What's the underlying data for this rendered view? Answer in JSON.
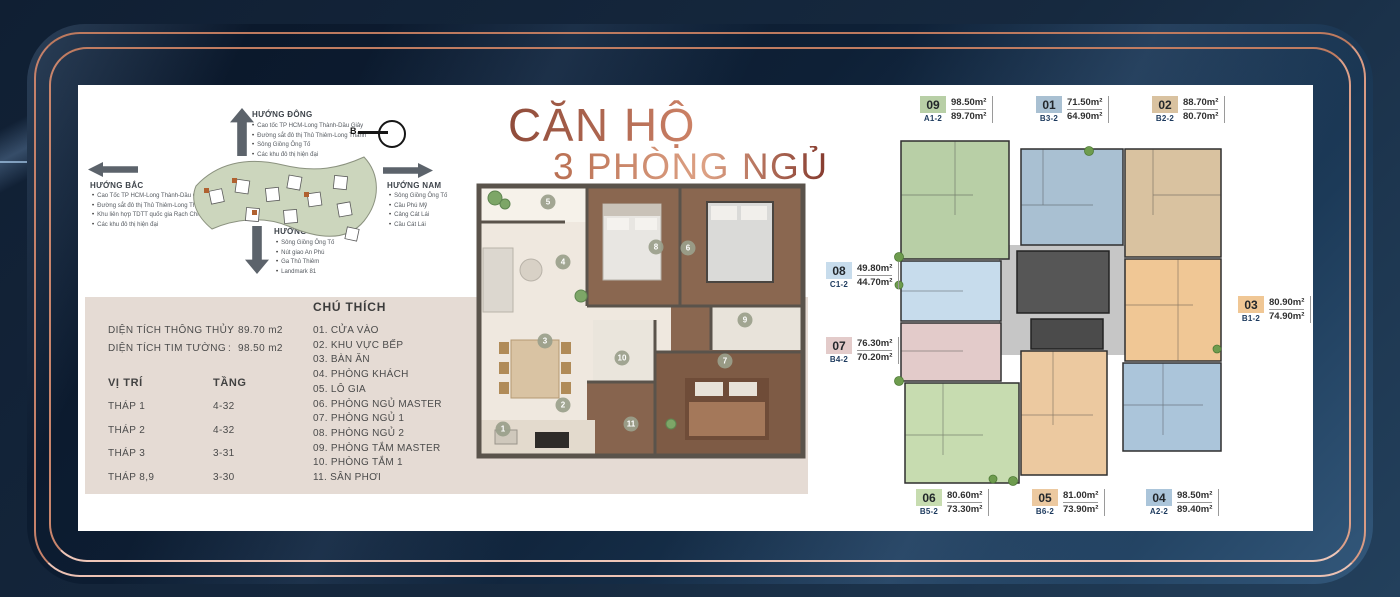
{
  "title": {
    "line1": "CĂN HỘ",
    "line2": "3 PHÒNG NGỦ"
  },
  "colors": {
    "accent_copper": "#c9846a",
    "navy": "#0e2036",
    "beige_panel": "#e5dbd4",
    "title_gradient_dark": "#8f4b3a",
    "title_gradient_light": "#dda184"
  },
  "compass": {
    "north_letter": "B",
    "dong": {
      "label": "HƯỚNG ĐÔNG",
      "items": [
        "Cao tốc TP HCM-Long Thành-Dầu Giây",
        "Đường sắt đô thị Thủ Thiêm-Long Thành",
        "Sông Giồng Ông Tố",
        "Các khu đô thị hiện đại"
      ]
    },
    "bac": {
      "label": "HƯỚNG BẮC",
      "items": [
        "Cao Tốc TP HCM-Long Thành-Dầu Giây",
        "Đường sắt đô thị Thủ Thiêm-Long Thành",
        "Khu liên hợp TDTT quốc gia Rạch Chiếc",
        "Các khu đô thị hiện đại"
      ]
    },
    "nam": {
      "label": "HƯỚNG NAM",
      "items": [
        "Sông Giồng Ông Tố",
        "Cầu Phú Mỹ",
        "Cảng Cát Lái",
        "Cầu Cát Lái"
      ]
    },
    "tay": {
      "label": "HƯỚNG TÂY",
      "items": [
        "Sông Giồng Ông Tố",
        "Nút giao An Phú",
        "Ga Thủ Thiêm",
        "Landmark 81"
      ]
    }
  },
  "specs": {
    "colon": ":",
    "rows": [
      {
        "label": "DIỆN TÍCH THÔNG THỦY",
        "value": "89.70 m2"
      },
      {
        "label": "DIỆN TÍCH TIM TƯỜNG",
        "value": "98.50 m2"
      }
    ],
    "position_header": "VỊ TRÍ",
    "floor_header": "TẦNG",
    "towers": [
      {
        "name": "THÁP 1",
        "floors": "4-32"
      },
      {
        "name": "THÁP 2",
        "floors": "4-32"
      },
      {
        "name": "THÁP 3",
        "floors": "3-31"
      },
      {
        "name": "THÁP 8,9",
        "floors": "3-30"
      }
    ]
  },
  "legend": {
    "title": "CHÚ THÍCH",
    "items": [
      "01. CỬA VÀO",
      "02. KHU VỰC BẾP",
      "03. BÀN ĂN",
      "04. PHÒNG KHÁCH",
      "05. LÔ GIA",
      "06. PHÒNG NGỦ MASTER",
      "07. PHÒNG NGỦ 1",
      "08. PHÒNG NGỦ 2",
      "09. PHÒNG TẮM MASTER",
      "10. PHÒNG TẮM 1",
      "11. SÂN PHƠI"
    ]
  },
  "floor_plan": {
    "markers": [
      {
        "n": "5",
        "left": "73px",
        "top": "32px"
      },
      {
        "n": "4",
        "left": "88px",
        "top": "92px"
      },
      {
        "n": "8",
        "left": "181px",
        "top": "77px"
      },
      {
        "n": "6",
        "left": "213px",
        "top": "78px"
      },
      {
        "n": "3",
        "left": "70px",
        "top": "171px"
      },
      {
        "n": "9",
        "left": "270px",
        "top": "150px"
      },
      {
        "n": "10",
        "left": "147px",
        "top": "188px"
      },
      {
        "n": "7",
        "left": "250px",
        "top": "191px"
      },
      {
        "n": "2",
        "left": "88px",
        "top": "235px"
      },
      {
        "n": "11",
        "left": "156px",
        "top": "254px"
      },
      {
        "n": "1",
        "left": "28px",
        "top": "259px"
      }
    ]
  },
  "units": [
    {
      "num": "09",
      "code": "A1-2",
      "a1": "98.50m²",
      "a2": "89.70m²",
      "chip": "#b8cfa6",
      "left": "920px",
      "top": "96px"
    },
    {
      "num": "01",
      "code": "B3-2",
      "a1": "71.50m²",
      "a2": "64.90m²",
      "chip": "#a9c0d2",
      "left": "1036px",
      "top": "96px"
    },
    {
      "num": "02",
      "code": "B2-2",
      "a1": "88.70m²",
      "a2": "80.70m²",
      "chip": "#d9c2a0",
      "left": "1152px",
      "top": "96px"
    },
    {
      "num": "08",
      "code": "C1-2",
      "a1": "49.80m²",
      "a2": "44.70m²",
      "chip": "#c7dcec",
      "left": "826px",
      "top": "262px"
    },
    {
      "num": "07",
      "code": "B4-2",
      "a1": "76.30m²",
      "a2": "70.20m²",
      "chip": "#e3cbca",
      "left": "826px",
      "top": "337px"
    },
    {
      "num": "03",
      "code": "B1-2",
      "a1": "80.90m²",
      "a2": "74.90m²",
      "chip": "#f0c795",
      "left": "1238px",
      "top": "296px"
    },
    {
      "num": "06",
      "code": "B5-2",
      "a1": "80.60m²",
      "a2": "73.30m²",
      "chip": "#c7dcb0",
      "left": "916px",
      "top": "489px"
    },
    {
      "num": "05",
      "code": "B6-2",
      "a1": "81.00m²",
      "a2": "73.90m²",
      "chip": "#ecc9a0",
      "left": "1032px",
      "top": "489px"
    },
    {
      "num": "04",
      "code": "A2-2",
      "a1": "98.50m²",
      "a2": "89.40m²",
      "chip": "#abc5da",
      "left": "1146px",
      "top": "489px"
    }
  ]
}
